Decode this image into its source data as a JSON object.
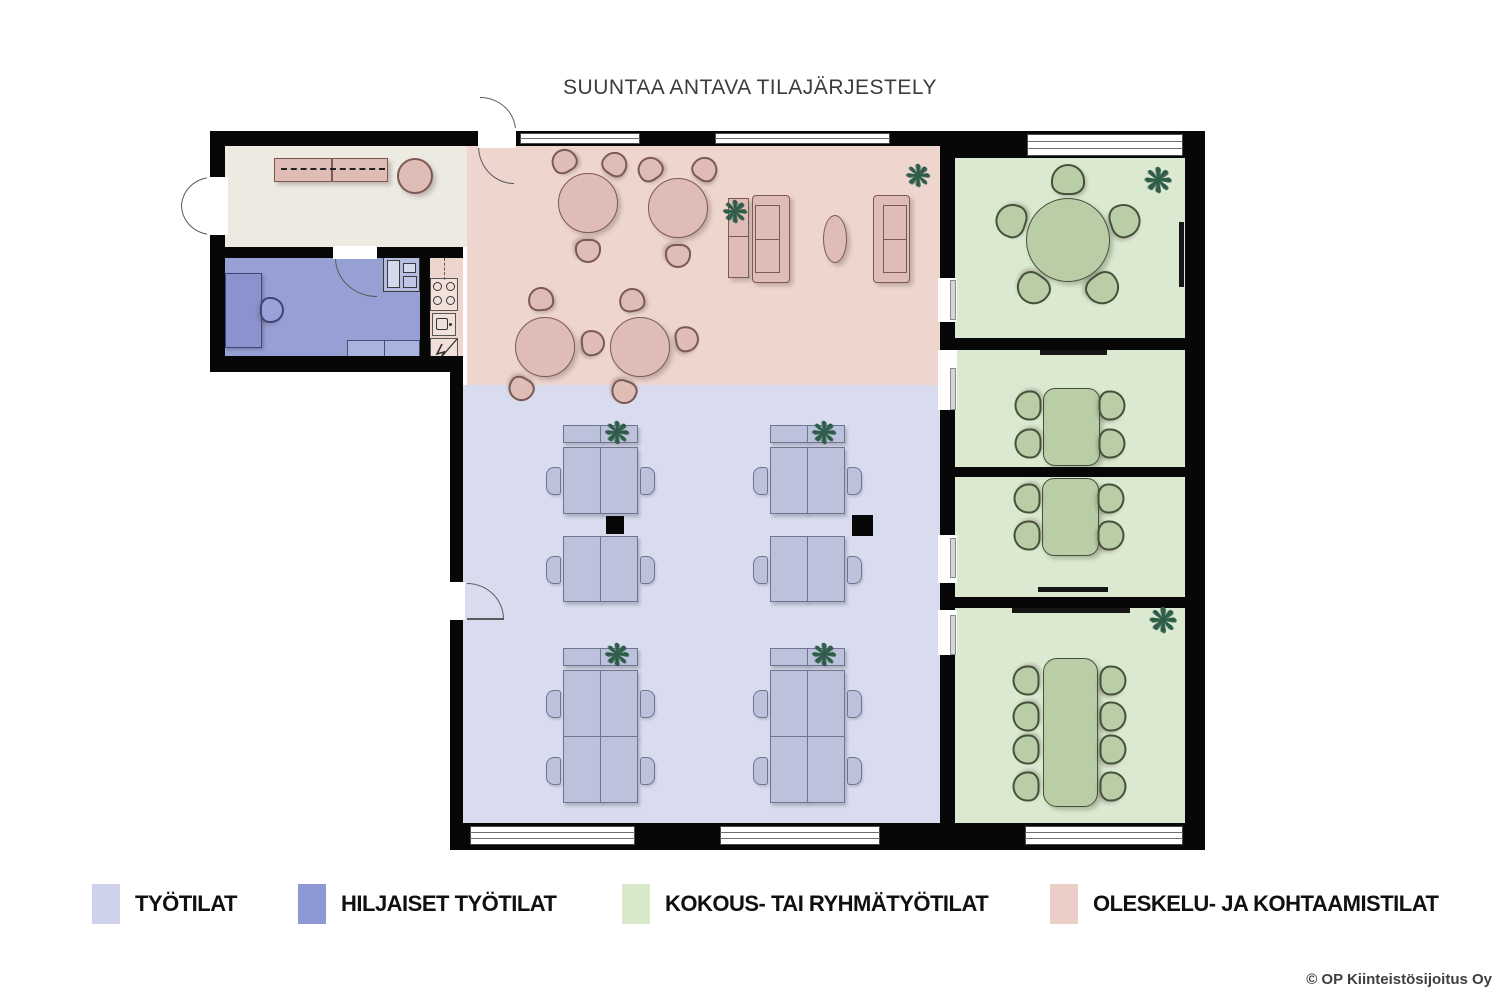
{
  "title": "SUUNTAA ANTAVA TILAJÄRJESTELY",
  "zones": {
    "tyotilat": {
      "label": "TYÖTILAT",
      "color": "#d8dcee",
      "legend_color": "#cdd2ea"
    },
    "hiljaiset": {
      "label": "HILJAISET TYÖTILAT",
      "color": "#97a0d4",
      "legend_color": "#8e98d4"
    },
    "kokous": {
      "label": "KOKOUS- TAI RYHMÄTYÖTILAT",
      "color": "#dbe9d1",
      "legend_color": "#d7e8cb"
    },
    "oleskelu": {
      "label": "OLESKELU- JA KOHTAAMISTILAT",
      "color": "#eed6cf",
      "legend_color": "#eacec7"
    },
    "entry": {
      "color": "#edeae2"
    }
  },
  "footer": {
    "copyright": "© OP Kiinteistösijoitus Oy"
  },
  "icons": {
    "plant": "❋"
  }
}
